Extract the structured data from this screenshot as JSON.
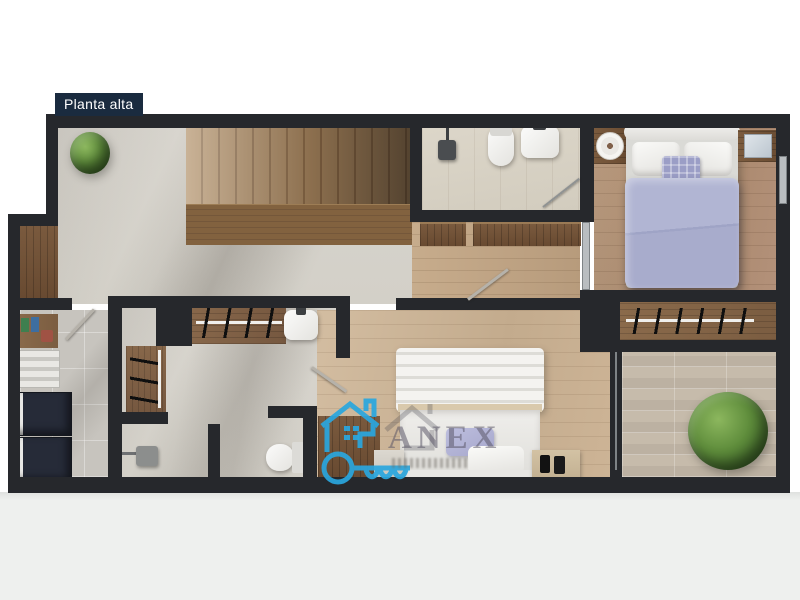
{
  "plan": {
    "label": "Planta alta"
  },
  "watermark": {
    "brand": "ANEX",
    "accent": "#2aa7df"
  },
  "palette": {
    "wall": "#26282c",
    "label_bg": "#1a2b3f",
    "concrete_floor": "#d7d4cd",
    "wood_floor_warm": "#b5947a",
    "wood_floor_light": "#cdb79c",
    "stone_tile": "#c6bbab",
    "duvet_blue": "#a5aacb",
    "plant_green": "#4f7d33",
    "appliance_navy": "#262b38"
  }
}
